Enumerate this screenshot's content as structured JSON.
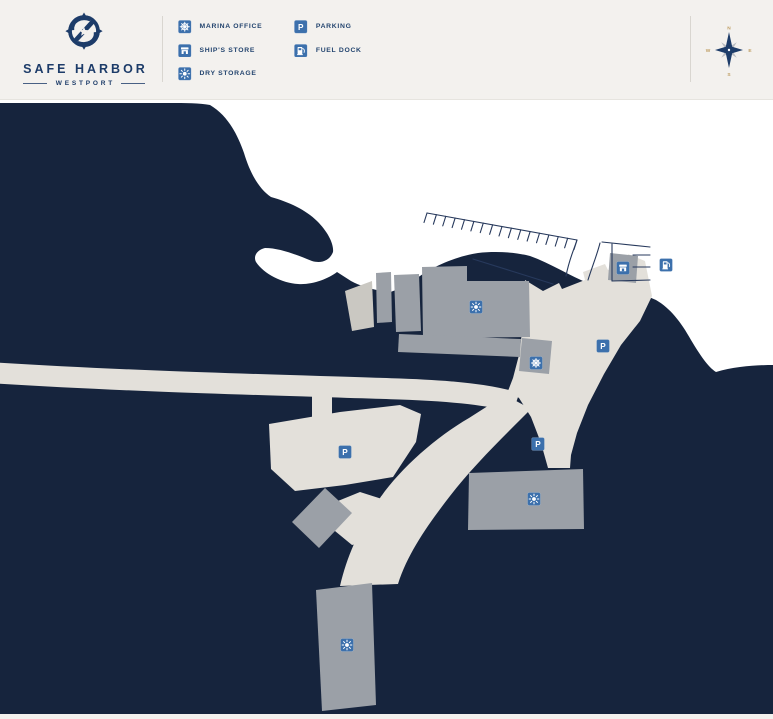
{
  "header": {
    "brand": {
      "name": "SAFE HARBOR",
      "location": "WESTPORT"
    },
    "legend": {
      "items": [
        {
          "id": "marina-office",
          "label": "MARINA OFFICE",
          "icon": "helm-icon",
          "symbol": "sym-helm"
        },
        {
          "id": "ships-store",
          "label": "SHIP'S STORE",
          "icon": "storefront-icon",
          "symbol": "sym-store"
        },
        {
          "id": "dry-storage",
          "label": "DRY STORAGE",
          "icon": "sun-icon",
          "symbol": "sym-sun"
        },
        {
          "id": "parking",
          "label": "PARKING",
          "icon": "parking-icon",
          "symbol": "sym-p"
        },
        {
          "id": "fuel-dock",
          "label": "FUEL DOCK",
          "icon": "fuel-pump-icon",
          "symbol": "sym-fuel"
        }
      ]
    },
    "compass": {
      "north": "N",
      "east": "E",
      "south": "S",
      "west": "W"
    }
  },
  "glyphs": {
    "parking_letter": "P"
  },
  "map": {
    "markers": [
      {
        "type": "dry-storage",
        "symbol": "sym-sun",
        "x": 476,
        "y": 207
      },
      {
        "type": "dry-storage",
        "symbol": "sym-sun",
        "x": 534,
        "y": 399
      },
      {
        "type": "dry-storage",
        "symbol": "sym-sun",
        "x": 347,
        "y": 545
      },
      {
        "type": "parking",
        "symbol": "sym-p",
        "x": 603,
        "y": 246
      },
      {
        "type": "parking",
        "symbol": "sym-p",
        "x": 538,
        "y": 344
      },
      {
        "type": "parking",
        "symbol": "sym-p",
        "x": 345,
        "y": 352
      },
      {
        "type": "marina-office",
        "symbol": "sym-helm",
        "x": 536,
        "y": 263
      },
      {
        "type": "ships-store",
        "symbol": "sym-store",
        "x": 623,
        "y": 168
      },
      {
        "type": "fuel-dock",
        "symbol": "sym-fuel",
        "x": 666,
        "y": 165
      }
    ],
    "parking_row": {
      "x1": 427,
      "y1": 113,
      "x2": 577,
      "y2": 140,
      "tick_count": 17
    },
    "colors": {
      "water": "#16243d",
      "land": "#ffffff",
      "pavement": "#e3e0da",
      "building": "#9ba0a7",
      "building_light": "#cac8c2",
      "icon_blue": "#3c70ac",
      "navy": "#1d3c69",
      "map_line": "#27395c",
      "compass_gold": "#bf9e63",
      "compass_gray": "#b9bcc2",
      "header_bg": "#f3f1ee",
      "divider": "#d9d6d0"
    }
  }
}
